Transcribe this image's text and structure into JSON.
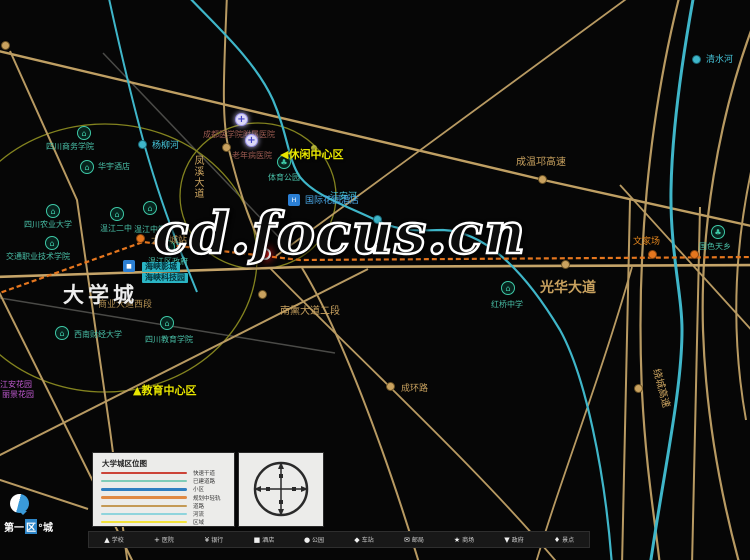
{
  "watermark": "cd.focus.cn",
  "map": {
    "big_city_label": "大学城",
    "area_labels": [
      {
        "prefix": "◀",
        "text": "休闲中心区",
        "x": 280,
        "y": 149
      },
      {
        "prefix": "▲",
        "text": "教育中心区",
        "x": 133,
        "y": 385
      }
    ],
    "place_labels": [
      {
        "text": "光华大道",
        "x": 540,
        "y": 281,
        "fs": 14,
        "color": "#c9a25f",
        "bold": true
      },
      {
        "text": "成温邛高速",
        "x": 516,
        "y": 158,
        "fs": 10,
        "color": "#c9a25f"
      },
      {
        "text": "绕城高速",
        "x": 660,
        "y": 368,
        "fs": 10,
        "color": "#c9a25f",
        "rot": 75
      },
      {
        "text": "凤溪大道",
        "x": 192,
        "y": 155,
        "fs": 10,
        "color": "#c9a25f",
        "vert": true
      },
      {
        "text": "南熏大道二段",
        "x": 280,
        "y": 307,
        "fs": 10,
        "color": "#c9a25f"
      },
      {
        "text": "商业大道西段",
        "x": 98,
        "y": 301,
        "fs": 9,
        "color": "#b08e52"
      },
      {
        "text": "成环路",
        "x": 401,
        "y": 385,
        "fs": 9,
        "color": "#c9a25f"
      },
      {
        "text": "清水河",
        "x": 706,
        "y": 56,
        "fs": 9,
        "color": "#45c3d8"
      },
      {
        "text": "杨柳河",
        "x": 152,
        "y": 142,
        "fs": 9,
        "color": "#45c3d8"
      },
      {
        "text": "江安河",
        "x": 330,
        "y": 193,
        "fs": 9,
        "color": "#45c3d8"
      },
      {
        "text": "文家场",
        "x": 633,
        "y": 238,
        "fs": 9,
        "color": "#e5871e"
      },
      {
        "text": "江安花园",
        "x": 0,
        "y": 381,
        "fs": 8,
        "color": "#c05ad0"
      },
      {
        "text": "丽景花园",
        "x": 2,
        "y": 391,
        "fs": 8,
        "color": "#c05ad0"
      },
      {
        "text": "国际花园酒店",
        "x": 305,
        "y": 197,
        "fs": 9,
        "color": "#4aa8e8"
      },
      {
        "text": "大学城站",
        "x": 151,
        "y": 237,
        "fs": 9,
        "color": "#c9a25f"
      }
    ],
    "chips": [
      {
        "text": "海峡影城",
        "x": 142,
        "y": 262
      },
      {
        "text": "海峡科技园",
        "x": 142,
        "y": 273
      }
    ],
    "pois": [
      {
        "type": "school",
        "x": 84,
        "y": 133,
        "label": "四川商务学院",
        "lx": 46,
        "ly": 143
      },
      {
        "type": "school",
        "x": 87,
        "y": 167,
        "label": "华宇酒店",
        "lx": 98,
        "ly": 163
      },
      {
        "type": "school",
        "x": 53,
        "y": 211,
        "label": "四川农业大学",
        "lx": 24,
        "ly": 221
      },
      {
        "type": "school",
        "x": 52,
        "y": 243,
        "label": "交通职业技术学院",
        "lx": 6,
        "ly": 253
      },
      {
        "type": "school",
        "x": 117,
        "y": 214,
        "label": "温江二中",
        "lx": 100,
        "ly": 225
      },
      {
        "type": "school",
        "x": 150,
        "y": 208,
        "label": "温江中学",
        "lx": 134,
        "ly": 226
      },
      {
        "type": "school",
        "x": 168,
        "y": 247,
        "label": "温江区政府",
        "lx": 148,
        "ly": 258
      },
      {
        "type": "park",
        "x": 284,
        "y": 162,
        "label": "体育公园",
        "lx": 268,
        "ly": 174
      },
      {
        "type": "park",
        "x": 718,
        "y": 232,
        "label": "国色天乡",
        "lx": 699,
        "ly": 243
      },
      {
        "type": "school",
        "x": 508,
        "y": 288,
        "label": "红桥中学",
        "lx": 491,
        "ly": 301
      },
      {
        "type": "school",
        "x": 62,
        "y": 333,
        "label": "西南财经大学",
        "lx": 74,
        "ly": 331
      },
      {
        "type": "school",
        "x": 167,
        "y": 323,
        "label": "四川教育学院",
        "lx": 145,
        "ly": 336
      },
      {
        "type": "hospital",
        "x": 242,
        "y": 120,
        "label": "成都医学院附属医院",
        "lx": 203,
        "ly": 131
      },
      {
        "type": "hospital",
        "x": 252,
        "y": 141,
        "label": "老年病医院",
        "lx": 232,
        "ly": 152
      },
      {
        "type": "cinema",
        "x": 130,
        "y": 267,
        "label": "",
        "lx": 0,
        "ly": 0
      },
      {
        "type": "hotel",
        "x": 295,
        "y": 201,
        "label": "",
        "lx": 0,
        "ly": 0
      },
      {
        "type": "station",
        "x": 143,
        "y": 241,
        "label": "",
        "lx": 0,
        "ly": 0
      },
      {
        "type": "station",
        "x": 655,
        "y": 257,
        "label": "",
        "lx": 0,
        "ly": 0
      },
      {
        "type": "station",
        "x": 697,
        "y": 257,
        "label": "",
        "lx": 0,
        "ly": 0
      },
      {
        "type": "roaddot",
        "x": 229,
        "y": 150,
        "label": "",
        "lx": 0,
        "ly": 0
      },
      {
        "type": "roaddot",
        "x": 545,
        "y": 182,
        "label": "",
        "lx": 0,
        "ly": 0
      },
      {
        "type": "roaddot",
        "x": 568,
        "y": 267,
        "label": "",
        "lx": 0,
        "ly": 0
      },
      {
        "type": "roaddot",
        "x": 641,
        "y": 391,
        "label": "",
        "lx": 0,
        "ly": 0
      },
      {
        "type": "roaddot",
        "x": 393,
        "y": 389,
        "label": "",
        "lx": 0,
        "ly": 0
      },
      {
        "type": "roaddot",
        "x": 265,
        "y": 297,
        "label": "",
        "lx": 0,
        "ly": 0
      },
      {
        "type": "roaddot",
        "x": 8,
        "y": 48,
        "label": "",
        "lx": 0,
        "ly": 0
      },
      {
        "type": "riverdot",
        "x": 145,
        "y": 147,
        "label": "",
        "lx": 0,
        "ly": 0
      },
      {
        "type": "riverdot",
        "x": 380,
        "y": 222,
        "label": "",
        "lx": 0,
        "ly": 0
      },
      {
        "type": "riverdot",
        "x": 699,
        "y": 62,
        "label": "",
        "lx": 0,
        "ly": 0
      },
      {
        "type": "olivedot",
        "x": 318,
        "y": 152,
        "label": "",
        "lx": 0,
        "ly": 0
      },
      {
        "type": "site",
        "x": 268,
        "y": 257,
        "label": "",
        "lx": 0,
        "ly": 0
      }
    ]
  },
  "legend": {
    "title": "大学城区位图",
    "items": [
      {
        "color": "#cc4438",
        "label": "快速干道"
      },
      {
        "color": "#7fccb8",
        "label": "已建道路"
      },
      {
        "color": "#2f7fc1",
        "label": "小区"
      },
      {
        "color": "#e08a44",
        "label": "规划中轻轨"
      },
      {
        "color": "#c49a56",
        "label": "道路"
      },
      {
        "color": "#8fd4dc",
        "label": "河流"
      },
      {
        "color": "#f2e23c",
        "label": "区域"
      }
    ]
  },
  "icon_strip": [
    {
      "glyph": "▲",
      "label": "学校"
    },
    {
      "glyph": "+",
      "label": "医院"
    },
    {
      "glyph": "¥",
      "label": "银行"
    },
    {
      "glyph": "■",
      "label": "酒店"
    },
    {
      "glyph": "●",
      "label": "公园"
    },
    {
      "glyph": "◆",
      "label": "车站"
    },
    {
      "glyph": "✉",
      "label": "邮局"
    },
    {
      "glyph": "★",
      "label": "商场"
    },
    {
      "glyph": "▼",
      "label": "政府"
    },
    {
      "glyph": "♦",
      "label": "景点"
    }
  ],
  "logo": {
    "pre": "第一",
    "mid": "区",
    "suf": "°城"
  }
}
